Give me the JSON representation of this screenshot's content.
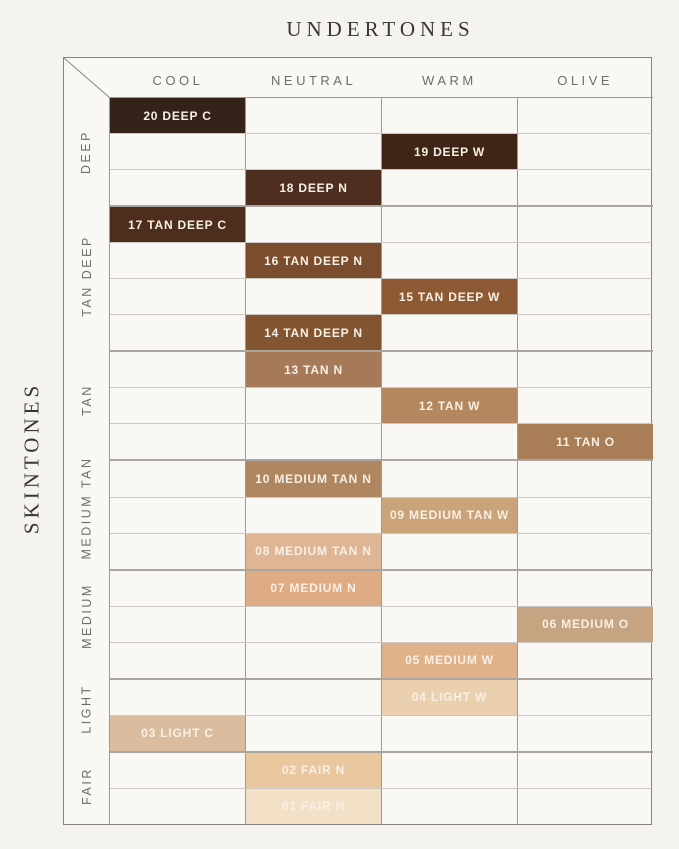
{
  "chart_data": {
    "type": "table",
    "title": "UNDERTONES",
    "row_axis_label": "SKINTONES",
    "columns": [
      "COOL",
      "NEUTRAL",
      "WARM",
      "OLIVE"
    ],
    "row_groups": [
      {
        "label": "DEEP",
        "rows": 3
      },
      {
        "label": "TAN DEEP",
        "rows": 4
      },
      {
        "label": "TAN",
        "rows": 3
      },
      {
        "label": "MEDIUM TAN",
        "rows": 3
      },
      {
        "label": "MEDIUM",
        "rows": 3
      },
      {
        "label": "LIGHT",
        "rows": 2
      },
      {
        "label": "FAIR",
        "rows": 2
      }
    ],
    "rows": [
      {
        "shade": "20 DEEP C",
        "column": "COOL",
        "group": "DEEP",
        "color": "#352219"
      },
      {
        "shade": "19 DEEP W",
        "column": "WARM",
        "group": "DEEP",
        "color": "#402516"
      },
      {
        "shade": "18 DEEP N",
        "column": "NEUTRAL",
        "group": "DEEP",
        "color": "#4e2e1e"
      },
      {
        "shade": "17 TAN DEEP C",
        "column": "COOL",
        "group": "TAN DEEP",
        "color": "#4d2e1c"
      },
      {
        "shade": "16 TAN DEEP N",
        "column": "NEUTRAL",
        "group": "TAN DEEP",
        "color": "#7b4c2d"
      },
      {
        "shade": "15 TAN DEEP W",
        "column": "WARM",
        "group": "TAN DEEP",
        "color": "#8e5a33"
      },
      {
        "shade": "14 TAN DEEP N",
        "column": "NEUTRAL",
        "group": "TAN DEEP",
        "color": "#835430"
      },
      {
        "shade": "13 TAN N",
        "column": "NEUTRAL",
        "group": "TAN",
        "color": "#a67a59"
      },
      {
        "shade": "12 TAN W",
        "column": "WARM",
        "group": "TAN",
        "color": "#b4875e"
      },
      {
        "shade": "11 TAN O",
        "column": "OLIVE",
        "group": "TAN",
        "color": "#a97d55"
      },
      {
        "shade": "10 MEDIUM TAN N",
        "column": "NEUTRAL",
        "group": "MEDIUM TAN",
        "color": "#af8660"
      },
      {
        "shade": "09 MEDIUM TAN W",
        "column": "WARM",
        "group": "MEDIUM TAN",
        "color": "#caa378"
      },
      {
        "shade": "08 MEDIUM TAN N",
        "column": "NEUTRAL",
        "group": "MEDIUM TAN",
        "color": "#deb696"
      },
      {
        "shade": "07 MEDIUM N",
        "column": "NEUTRAL",
        "group": "MEDIUM",
        "color": "#ddab84"
      },
      {
        "shade": "06 MEDIUM O",
        "column": "OLIVE",
        "group": "MEDIUM",
        "color": "#c6a381"
      },
      {
        "shade": "05 MEDIUM W",
        "column": "WARM",
        "group": "MEDIUM",
        "color": "#e1b189"
      },
      {
        "shade": "04 LIGHT W",
        "column": "WARM",
        "group": "LIGHT",
        "color": "#ead0ae"
      },
      {
        "shade": "03 LIGHT C",
        "column": "COOL",
        "group": "LIGHT",
        "color": "#dabd9f"
      },
      {
        "shade": "02 FAIR N",
        "column": "NEUTRAL",
        "group": "FAIR",
        "color": "#eac79f"
      },
      {
        "shade": "01 FAIR N",
        "column": "NEUTRAL",
        "group": "FAIR",
        "color": "#f2e1c6"
      }
    ]
  },
  "colors": {
    "background": "#f5f3f0",
    "panel": "#f9f8f5",
    "heading_text": "#3a3631",
    "muted_label_text": "#6f6d69",
    "swatch_text": "#f7f0e6",
    "row_line": "#cac7c2",
    "group_line": "#a9a6a0",
    "column_line": "#9d9a95",
    "outer_border": "#87847f"
  }
}
